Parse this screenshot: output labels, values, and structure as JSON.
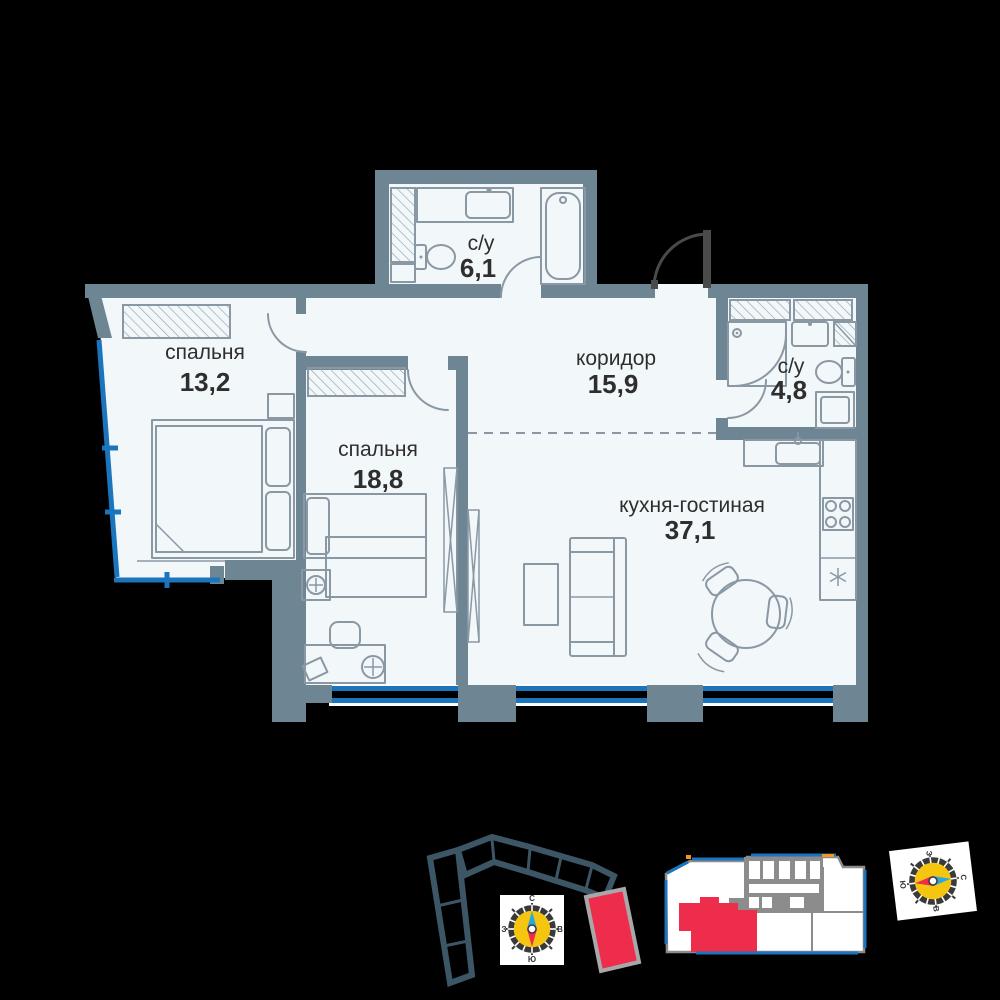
{
  "rooms": {
    "bedroom_small": {
      "name": "спальня",
      "area": "13,2"
    },
    "bedroom_large": {
      "name": "спальня",
      "area": "18,8"
    },
    "bathroom_top": {
      "name": "с/у",
      "area": "6,1"
    },
    "corridor": {
      "name": "коридор",
      "area": "15,9"
    },
    "bathroom_small": {
      "name": "с/у",
      "area": "4,8"
    },
    "kitchen_living": {
      "name": "кухня-гостиная",
      "area": "37,1"
    }
  },
  "compass": {
    "north": "С",
    "south": "Ю",
    "west": "З",
    "east": "В"
  },
  "colors": {
    "wall": "#6E8594",
    "floor": "#F2F7FA",
    "window": "#1A75BC",
    "highlight": "#EE2C4C",
    "compassYellow": "#F6C50F",
    "needleBlue": "#29A8E0",
    "outline": "#3C5666",
    "doorDark": "#4A4A4A",
    "fixture": "#8A98A4",
    "text": "#2E2E2E",
    "miniGray": "#8C8C8C",
    "accentOrange": "#F7941D"
  }
}
